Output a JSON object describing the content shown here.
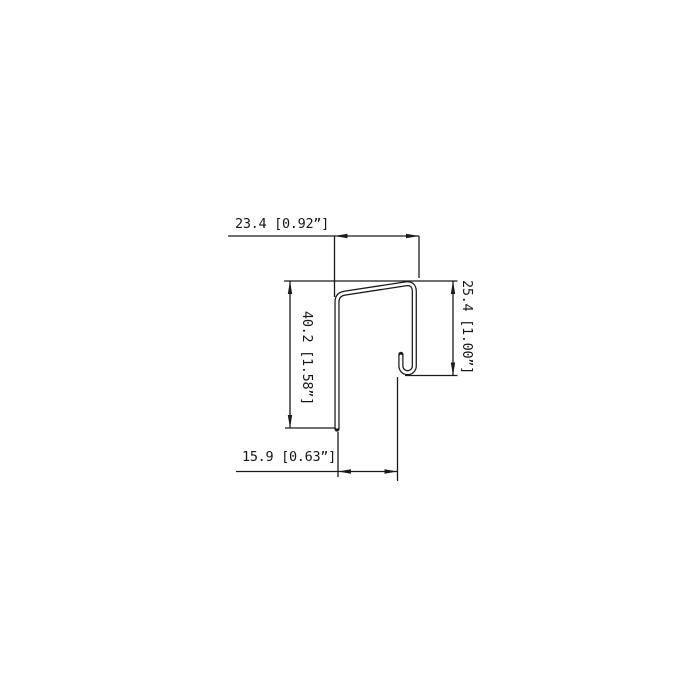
{
  "page": {
    "background_color": "#ffffff",
    "line_color": "#1a1a1a",
    "text_color": "#161616"
  },
  "drawing": {
    "type": "technical-cross-section",
    "subject": "j-channel-trim-profile",
    "units": "mm [inches]",
    "dimensions": {
      "top_width": {
        "label": "23.4 [0.92”]",
        "mm": "23.4",
        "inches": "0.92”"
      },
      "left_height": {
        "label": "40.2 [1.58”]",
        "mm": "40.2",
        "inches": "1.58”"
      },
      "right_height": {
        "label": "25.4 [1.00”]",
        "mm": "25.4",
        "inches": "1.00”"
      },
      "bottom_width": {
        "label": "15.9 [0.63”]",
        "mm": "15.9",
        "inches": "0.63”"
      }
    }
  }
}
